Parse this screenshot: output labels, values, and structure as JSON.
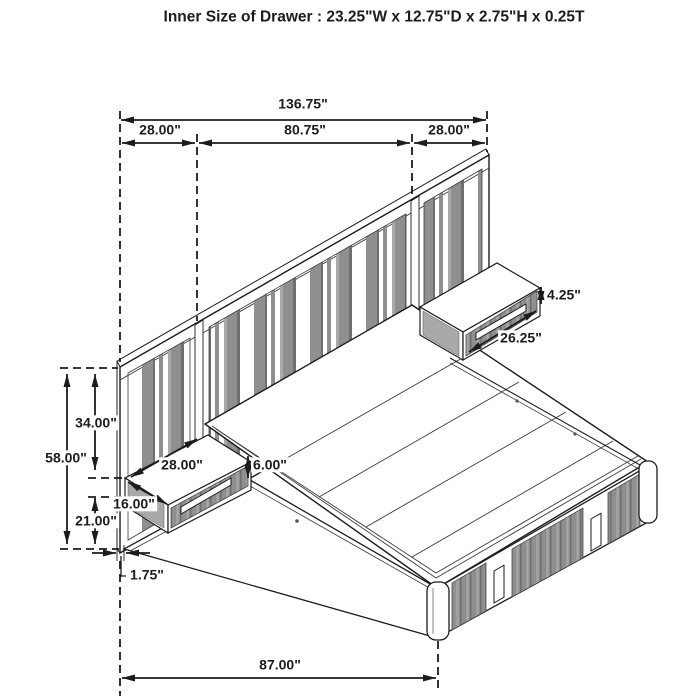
{
  "title": "Inner Size of Drawer : 23.25\"W x 12.75\"D x 2.75\"H x 0.25T",
  "dims": {
    "total_width": "136.75\"",
    "left_wing_width": "28.00\"",
    "center_width": "80.75\"",
    "right_wing_width": "28.00\"",
    "drawer_face_height": "4.25\"",
    "drawer_front_width": "26.25\"",
    "overall_height": "58.00\"",
    "top_to_shelf": "34.00\"",
    "shelf_width": "28.00\"",
    "shelf_height": "6.00\"",
    "shelf_depth": "16.00\"",
    "floor_to_shelf": "21.00\"",
    "panel_thickness": "1.75\"",
    "bed_length": "87.00\""
  },
  "colors": {
    "ink": "#1c1c1c",
    "panel-gray": "#8f8f8f",
    "panel-gray-dark": "#6f6f6f",
    "panel-gray-light": "#a9a9a9",
    "bg": "#ffffff"
  }
}
